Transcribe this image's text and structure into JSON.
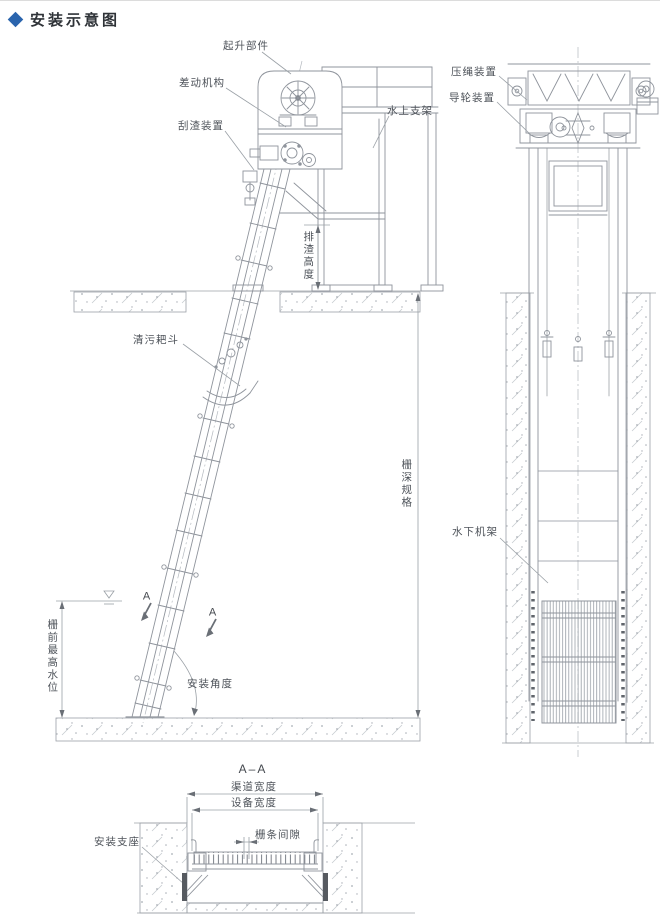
{
  "header": {
    "title": "安装示意图"
  },
  "colors": {
    "accent": "#2a64ad",
    "line_gray": "#8f949c",
    "dim_gray": "#9aa0a6"
  },
  "front_view": {
    "labels": {
      "hoist": "起升部件",
      "differential": "差动机构",
      "scraper": "刮渣装置",
      "platform": "水上支架",
      "discharge_height": "排渣高度",
      "rake_bucket": "清污耙斗",
      "max_water_level": "栅前最高水位",
      "section_mark": "A",
      "install_angle": "安装角度",
      "screen_depth": "栅深规格"
    }
  },
  "side_view": {
    "labels": {
      "rope_press": "压绳装置",
      "guide_wheel": "导轮装置",
      "underwater_frame": "水下机架"
    }
  },
  "section_view": {
    "title": "A–A",
    "labels": {
      "channel_width": "渠道宽度",
      "equipment_width": "设备宽度",
      "bar_gap": "栅条间隙",
      "mount_base": "安装支座"
    }
  }
}
